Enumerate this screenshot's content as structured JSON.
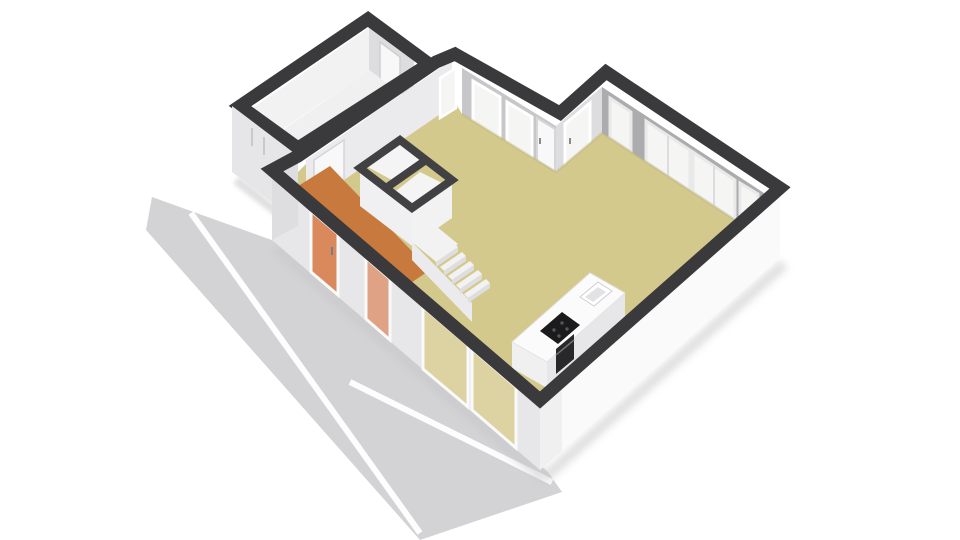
{
  "scene": {
    "type": "isometric-3d-floorplan-render",
    "description": "3D dollhouse-style floor plan of a ground floor with living room / kitchen, hallway, garage-storage room, closet, staircase and kitchen island, viewed from above at an angle, with a gray road band with white lane stripes in front"
  },
  "colors": {
    "background": "#ffffff",
    "road": "#d3d3d5",
    "road_stripe": "#ffffff",
    "wall_cap": "#3a3a3c",
    "partition_cap": "#414143",
    "ext_front_left": "#e7e7e9",
    "ext_front_right": "#fafafb",
    "ext_garage": "#e6e6e8",
    "ext_jog": "#dedee0",
    "int_wall_dark": "#acacae",
    "int_wall_mid": "#c7c7c9",
    "int_wall_light": "#dddddf",
    "int_wall_white": "#f2f2f3",
    "garage_wall_face": "#ebebed",
    "floor_living": "#d3c98c",
    "floor_hall": "#c8793d",
    "floor_garage": "#f0f0f1",
    "glass_white": "#f5f5f4",
    "glass_living": "#ddd3a2",
    "glass_hall": "#d9895c",
    "glass_hall_light": "#dfa285",
    "door_white": "#f8f8f9",
    "frame_white": "#fafafa",
    "frame_gray": "#c9c9cb",
    "closet_face": "#f0f0f2",
    "closet_cell": "#f4f4f5",
    "stair": "#f2f2f3",
    "stair_riser": "#dedee0",
    "stair_side": "#ebebed",
    "island_top": "#fbfbfb",
    "island_side": "#e7e7e9",
    "island_front": "#f0f0f1",
    "cooktop": "#1b1b1d",
    "oven": "#28282a",
    "sink_rim": "#ffffff",
    "sink_basin": "#e2e2e4",
    "shadow": "#c6c6c8",
    "floor_edge_shade": "#b5ab74"
  },
  "rooms": [
    {
      "name": "living-room-kitchen",
      "floor": "khaki"
    },
    {
      "name": "hallway",
      "floor": "orange"
    },
    {
      "name": "garage-storage",
      "floor": "white"
    },
    {
      "name": "closet",
      "floor": "white"
    }
  ],
  "objects": [
    "road",
    "lane-stripes",
    "garage-room",
    "living-room-floor",
    "hallway-floor",
    "closet-partitions",
    "staircase",
    "kitchen-island",
    "cooktop",
    "sink",
    "oven",
    "front-door",
    "glass-sliding-doors",
    "windows",
    "interior-doors"
  ]
}
